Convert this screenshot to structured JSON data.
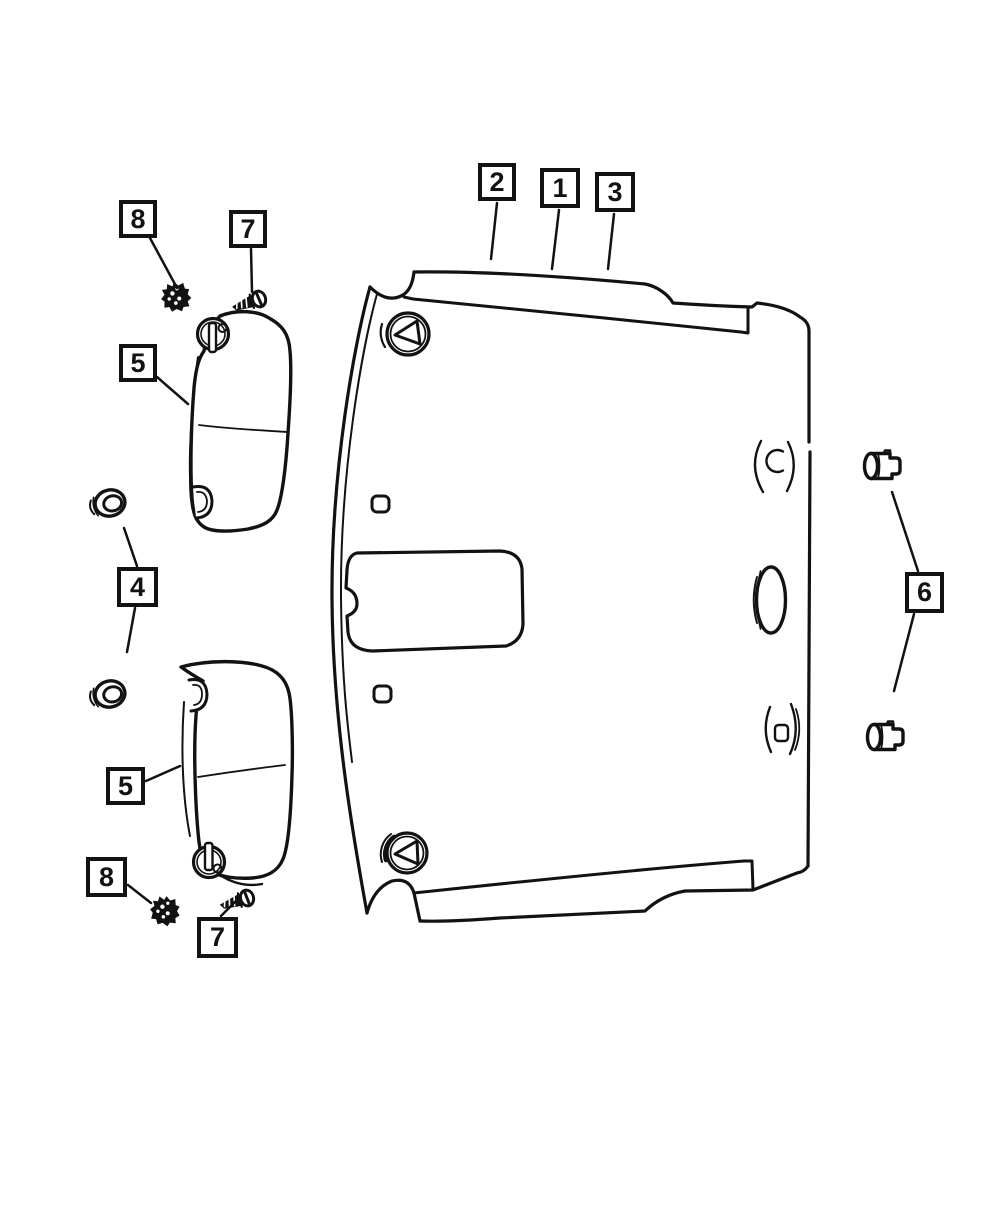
{
  "page": {
    "background_color": "#ffffff",
    "line_color": "#121212",
    "description": "Exploded parts line diagram: headliner panel with sun visors, retainers, screws and lamp sockets"
  },
  "callouts": {
    "box_1": {
      "label": "1"
    },
    "box_2": {
      "label": "2"
    },
    "box_3": {
      "label": "3"
    },
    "box_4": {
      "label": "4"
    },
    "box_5_upper": {
      "label": "5"
    },
    "box_5_lower": {
      "label": "5"
    },
    "box_6": {
      "label": "6"
    },
    "box_7_upper": {
      "label": "7"
    },
    "box_7_lower": {
      "label": "7"
    },
    "box_8_upper": {
      "label": "8"
    },
    "box_8_lower": {
      "label": "8"
    }
  }
}
